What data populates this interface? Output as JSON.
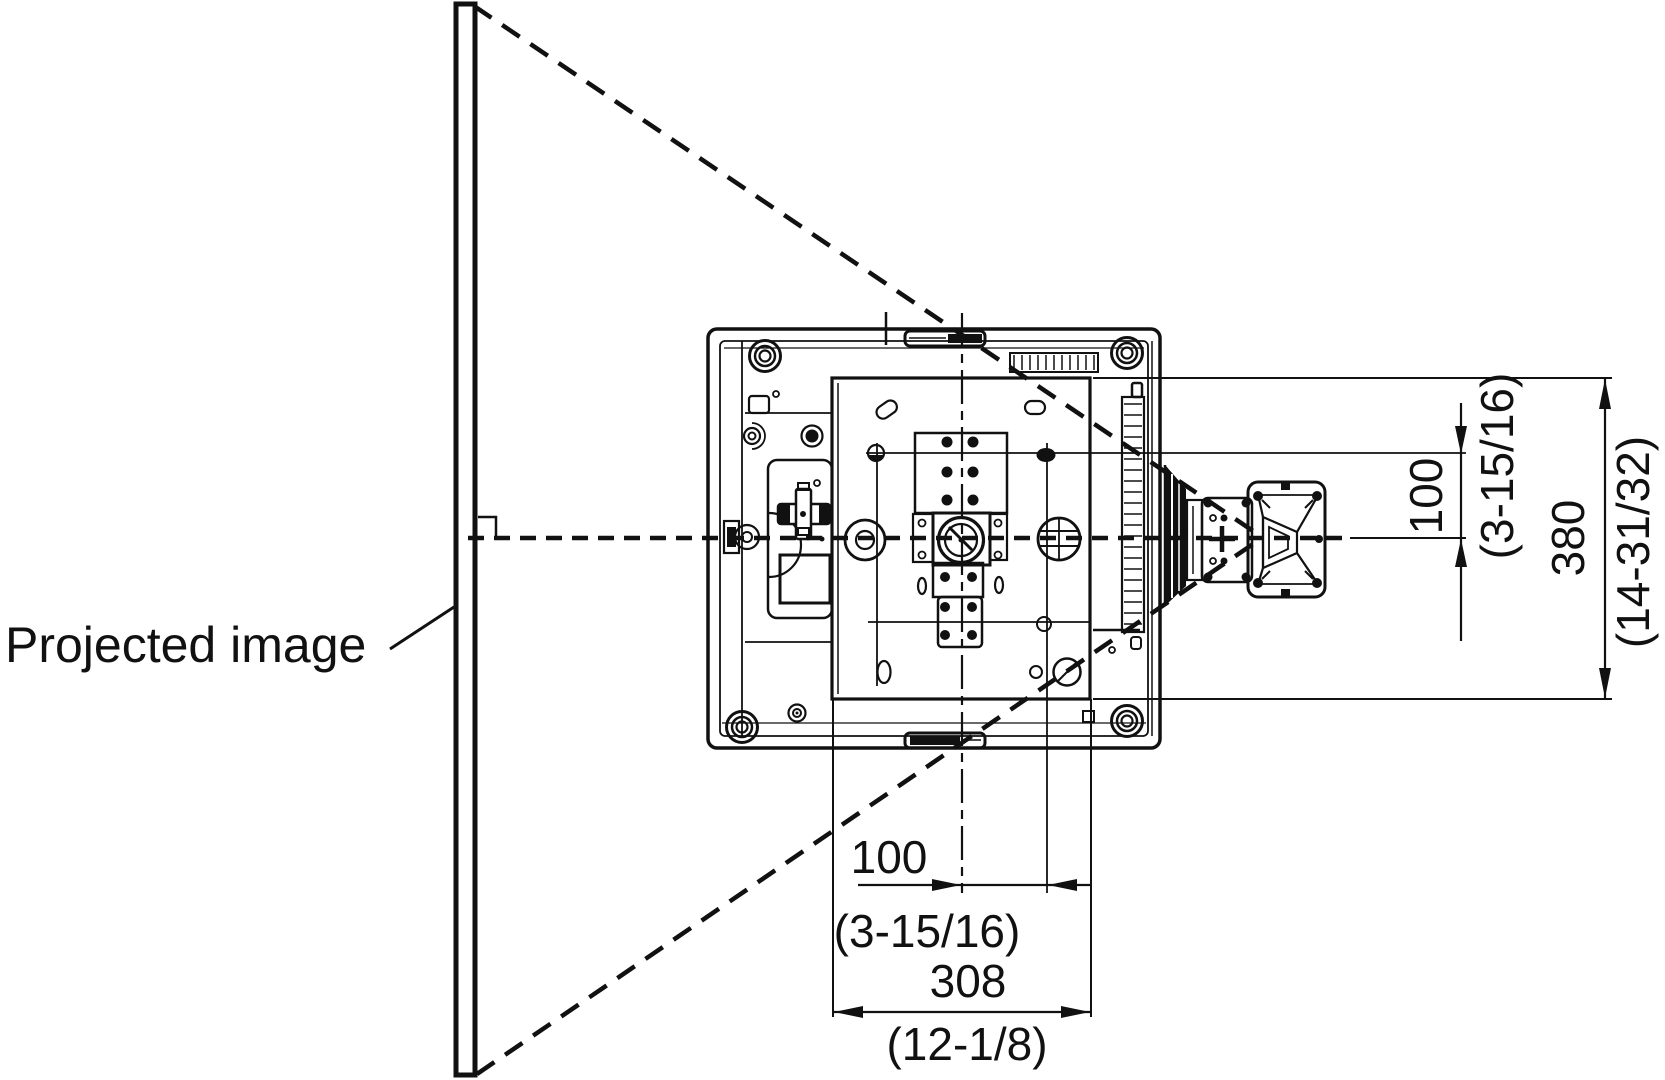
{
  "diagram": {
    "type": "technical-dimension-drawing",
    "subject": "projector bottom view with wall bracket and projection cone",
    "colors": {
      "ink": "#111111",
      "paper": "#ffffff"
    }
  },
  "labels": {
    "projected_image": "Projected image"
  },
  "dimensions": {
    "vertical_offset": {
      "mm": "100",
      "inches": "(3-15/16)"
    },
    "vertical_overall": {
      "mm": "380",
      "inches": "(14-31/32)"
    },
    "horizontal_offset": {
      "mm": "100",
      "inches": "(3-15/16)"
    },
    "horizontal_overall": {
      "mm": "308",
      "inches": "(12-1/8)"
    }
  }
}
